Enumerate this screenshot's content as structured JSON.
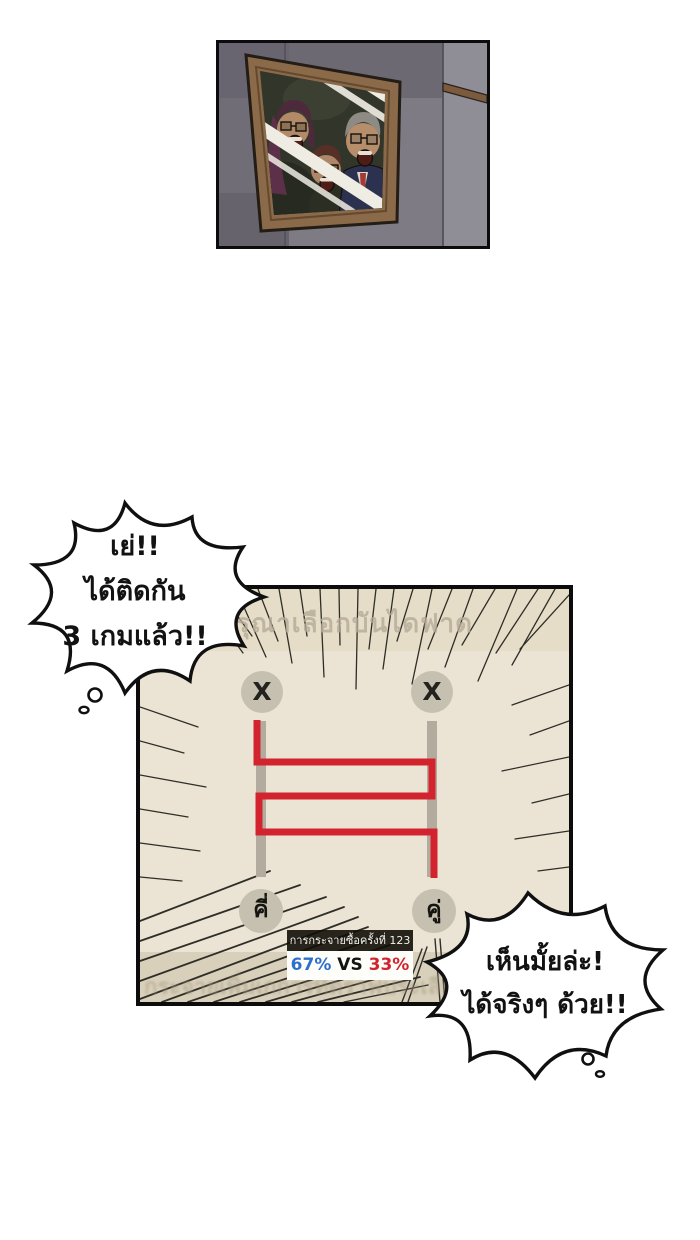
{
  "comic": {
    "thought_bubble_left": {
      "lines": [
        "เย่!!",
        "ได้ติดกัน",
        "3 เกมแล้ว!!"
      ]
    },
    "thought_bubble_right": {
      "lines": [
        "เห็นมั้ยล่ะ!",
        "ได้จริงๆ ด้วย!!"
      ]
    },
    "ladder_game": {
      "faded_header": "รุณาเลือกบันไดฟาด",
      "faded_footer": "กระจายเพิ่มเกการที่ดราฟประเลี่ย",
      "top_left_label": "X",
      "top_right_label": "X",
      "bottom_left_label": "คี่",
      "bottom_right_label": "คู่",
      "stats_title": "การกระจายซื้อครั้งที่ 123",
      "stats_left": "67%",
      "stats_vs": "VS",
      "stats_right": "33%",
      "colors": {
        "stats_left_value": "#2e6fcc",
        "stats_right_value": "#d2232e",
        "path_red": "#d2232e",
        "panel_bg": "#ebe4d4",
        "band_top": "#e6ddc8",
        "band_bottom": "#d9d0bb",
        "rail_gray": "#b3ac9e",
        "circle_gray": "#c6c0b1"
      }
    }
  }
}
